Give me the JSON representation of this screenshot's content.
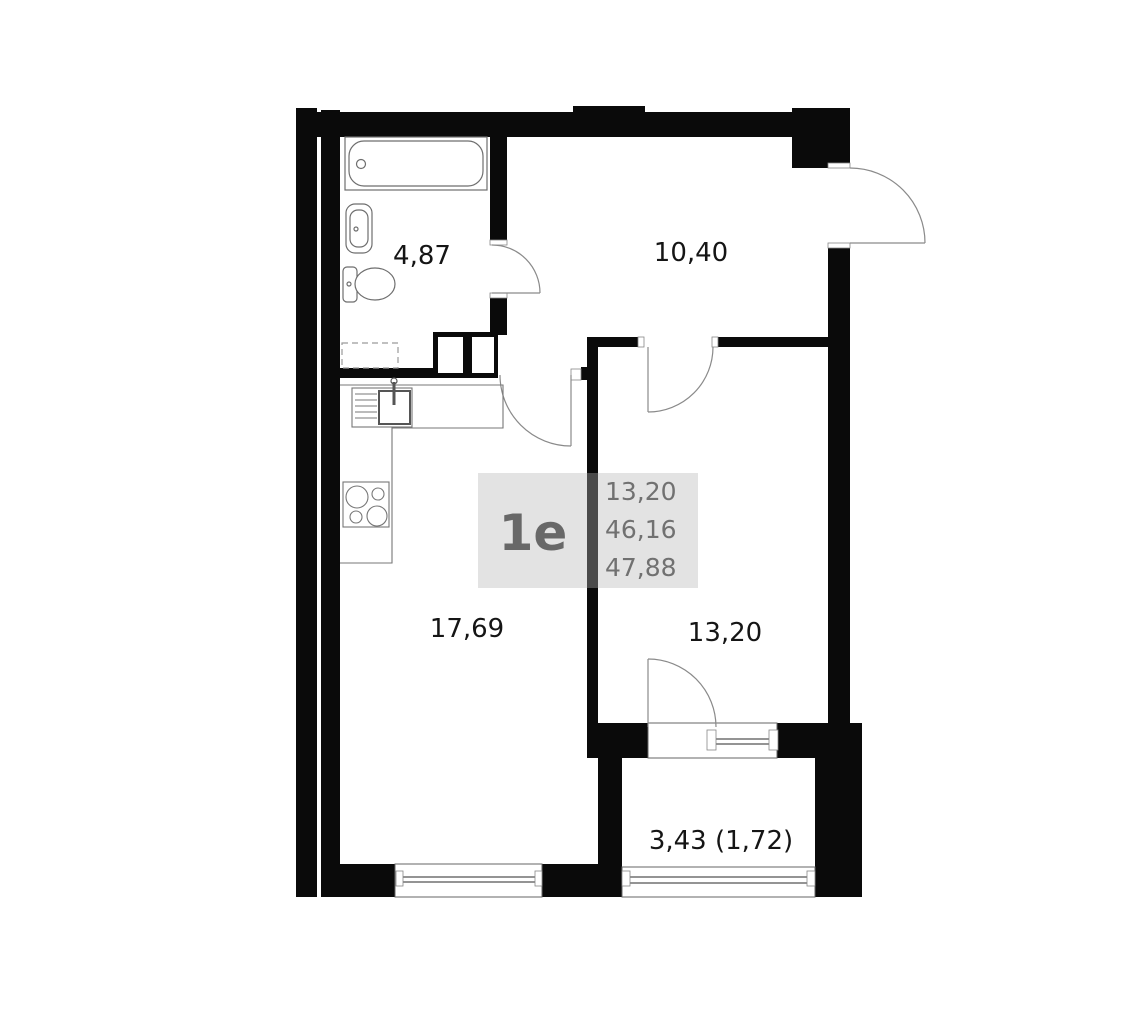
{
  "plan": {
    "unit_label": "1e",
    "area_summary": {
      "living_area": "13,20",
      "area_no_balcony": "46,16",
      "total_area": "47,88"
    },
    "rooms": {
      "bathroom_area": "4,87",
      "hallway_area": "10,40",
      "living_kitchen_area": "17,69",
      "bedroom_area": "13,20",
      "balcony_area": "3,43 (1,72)"
    },
    "colors": {
      "wall": "#0a0a0a",
      "label_text": "#151515",
      "overlay_bg": "#e3e3e3",
      "overlay_text": "#6e6e6e",
      "drawing_line": "#8a8a8a"
    }
  }
}
